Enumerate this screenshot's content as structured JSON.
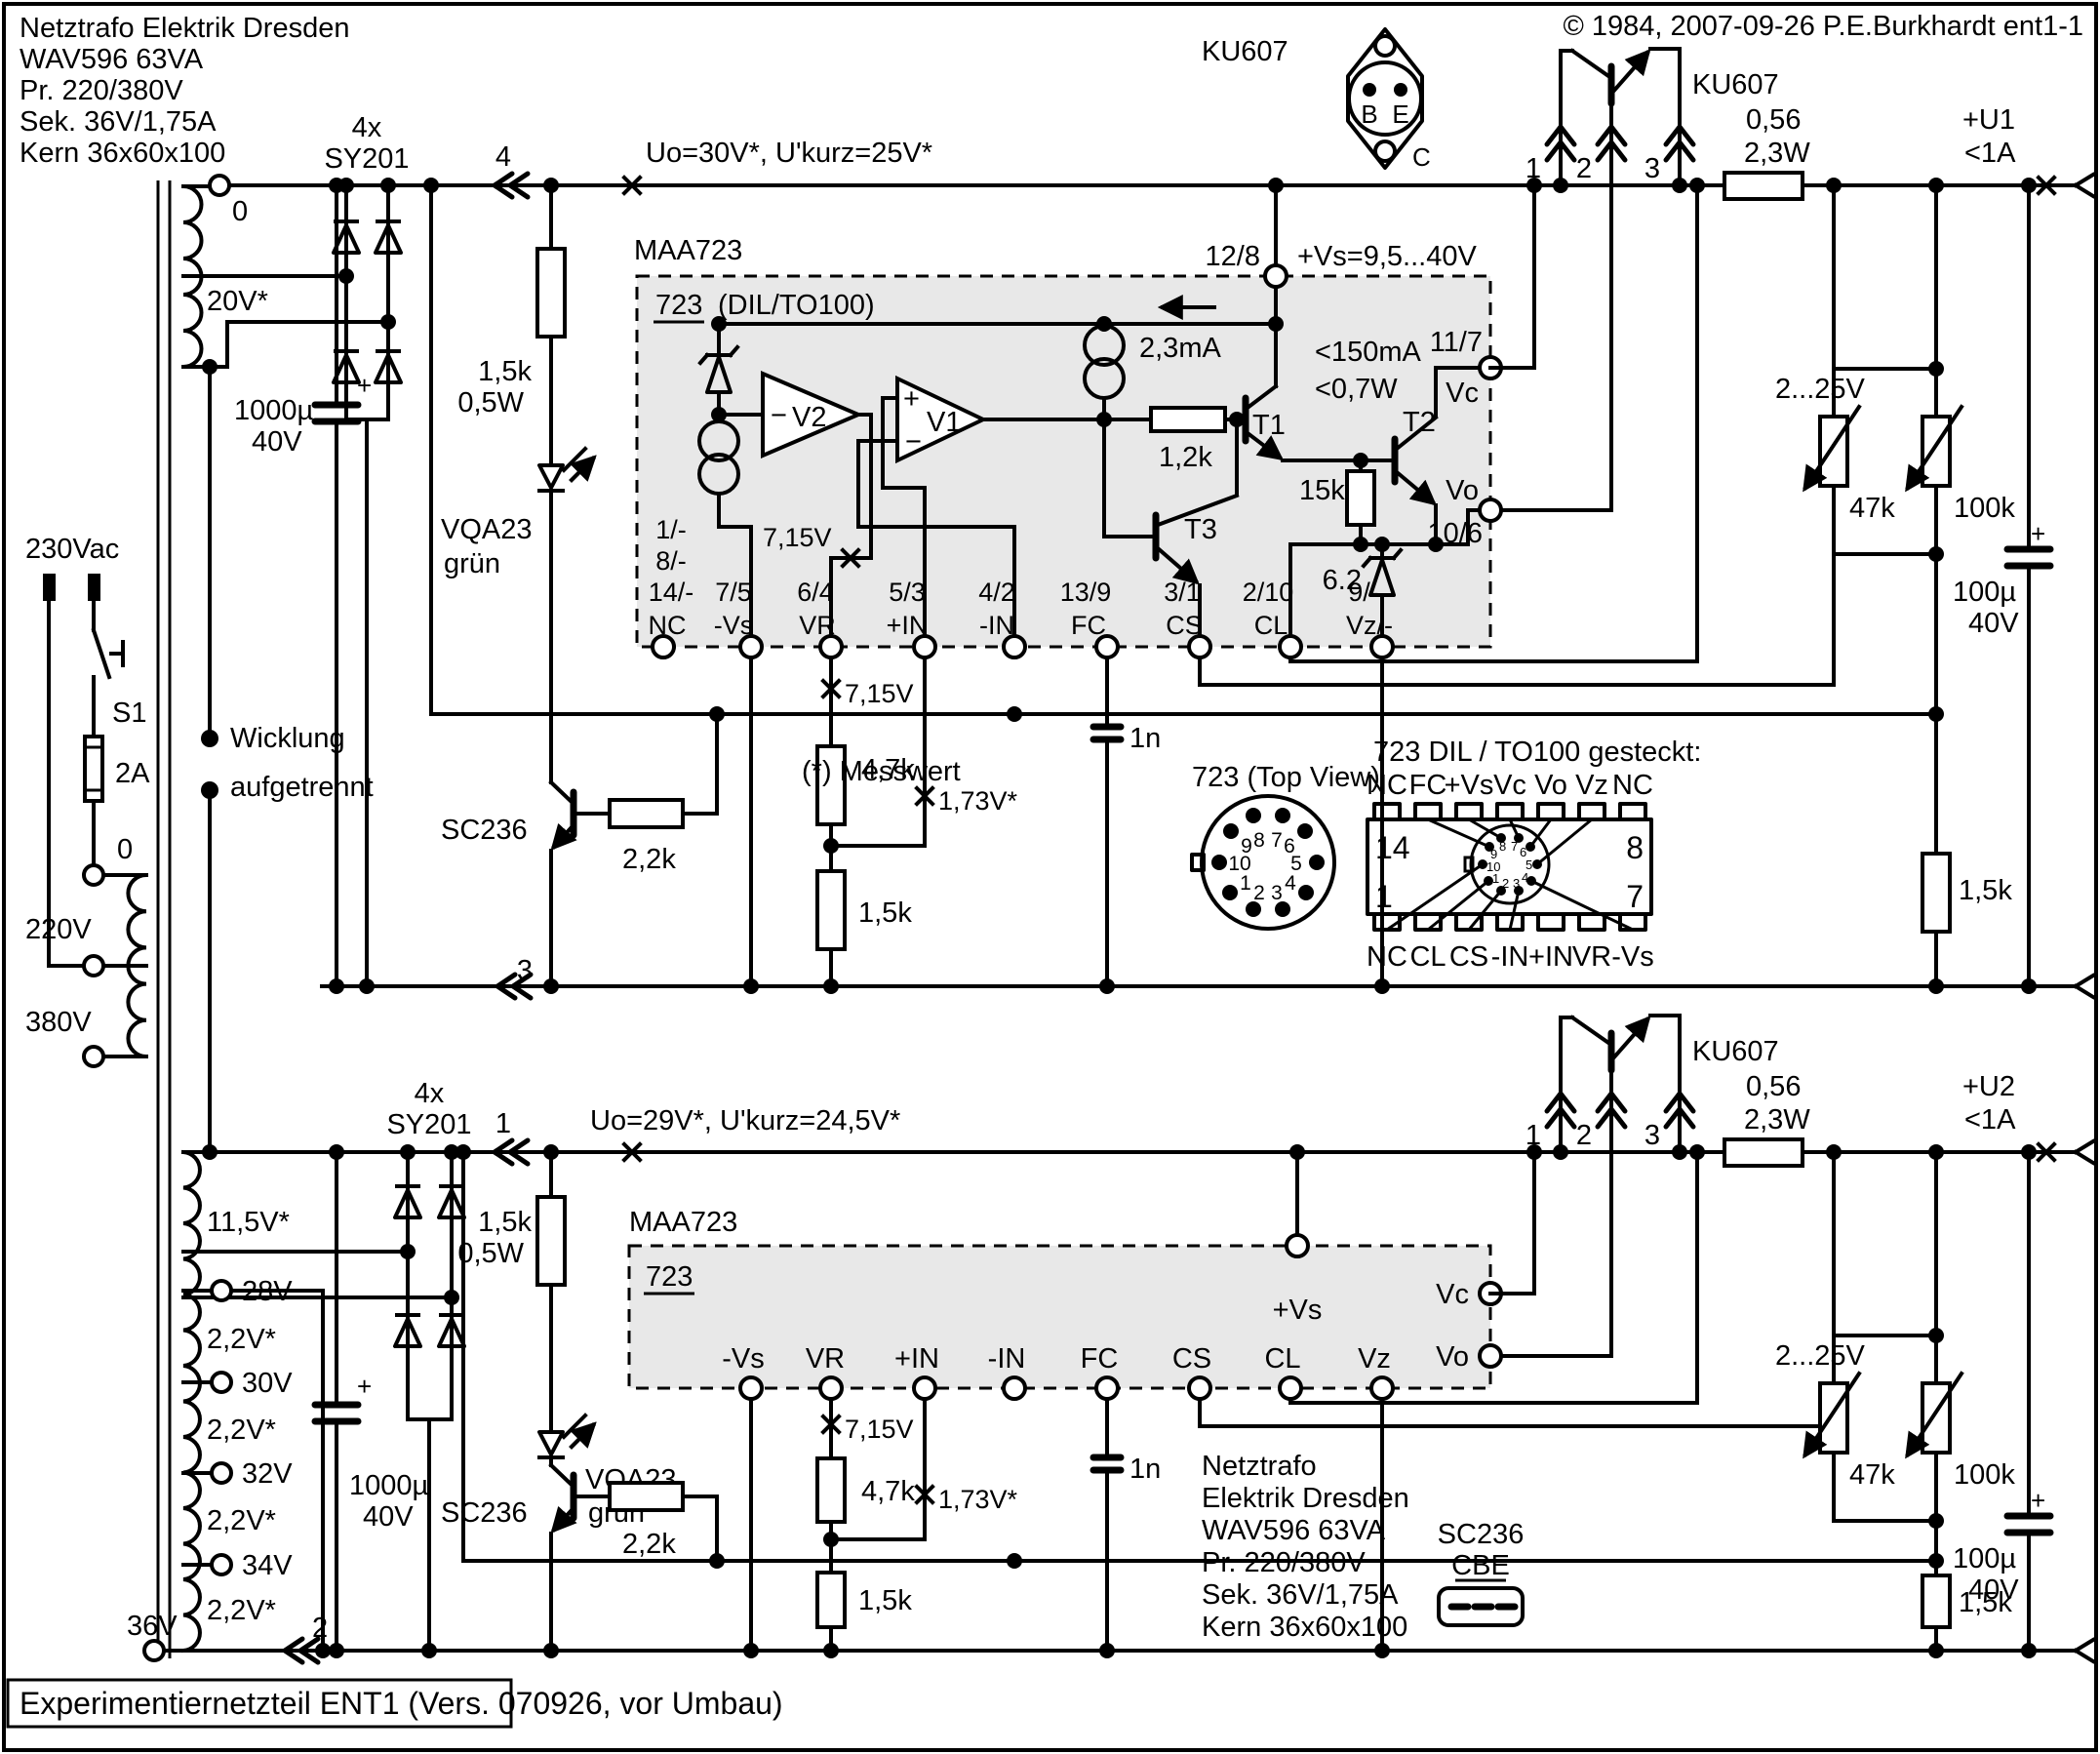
{
  "header": {
    "info": [
      "Netztrafo Elektrik Dresden",
      "WAV596 63VA",
      "Pr. 220/380V",
      "Sek. 36V/1,75A",
      "Kern 36x60x100"
    ],
    "copyright": "© 1984, 2007-09-26 P.E.Burkhardt ent1-1"
  },
  "footer": {
    "title": "Experimentiernetzteil ENT1 (Vers. 070926, vor Umbau)"
  },
  "note": {
    "messwert": "(*) Messwert"
  },
  "mains": {
    "label": "230Vac",
    "switch": "S1",
    "fuse": "2A",
    "taps": [
      "0",
      "220V",
      "380V"
    ],
    "note1": "Wicklung",
    "note2": "aufgetrennt"
  },
  "windings": {
    "w1": "20V*",
    "w1_top": "0",
    "w2": "11,5V*",
    "w2_taps": [
      "28V",
      "30V",
      "32V",
      "34V",
      "36V"
    ],
    "w2_steps": [
      "2,2V*",
      "2,2V*",
      "2,2V*",
      "2,2V*"
    ]
  },
  "s1": {
    "bridge_qty": "4x",
    "bridge_part": "SY201",
    "conn_pos": "4",
    "conn_neg": "3",
    "uo": "Uo=30V*, U'kurz=25V*",
    "r_led": "1,5k",
    "r_led_w": "0,5W",
    "cap": "1000µ",
    "cap_v": "40V",
    "led": "VQA23",
    "led_color": "grün",
    "tr": "SC236",
    "r_base": "2,2k",
    "r_div1": "4,7k",
    "r_div2": "1,5k",
    "m_ref": "7,15V",
    "m_in": "1,73V*",
    "cap_fc": "1n",
    "pass": "KU607",
    "p1": "1",
    "p2": "2",
    "p3": "3",
    "r_out": "0,56",
    "r_out_w": "2,3W",
    "out": "+U1",
    "out_i": "<1A",
    "adj_range": "2...25V",
    "pot1": "47k",
    "pot2": "100k",
    "cap_out": "100µ",
    "cap_out_v": "40V",
    "r_sense": "1,5k",
    "plus": "+"
  },
  "s2": {
    "bridge_qty": "4x",
    "bridge_part": "SY201",
    "conn_pos": "1",
    "conn_neg": "2",
    "uo": "Uo=29V*, U'kurz=24,5V*",
    "r_led": "1,5k",
    "r_led_w": "0,5W",
    "cap": "1000µ",
    "cap_v": "40V",
    "led": "VQA23",
    "led_color": "grün",
    "tr": "SC236",
    "r_base": "2,2k",
    "r_div1": "4,7k",
    "r_div2": "1,5k",
    "m_ref": "7,15V",
    "m_in": "1,73V*",
    "cap_fc": "1n",
    "pass": "KU607",
    "p1": "1",
    "p2": "2",
    "p3": "3",
    "r_out": "0,56",
    "r_out_w": "2,3W",
    "out": "+U2",
    "out_i": "<1A",
    "adj_range": "2...25V",
    "pot1": "47k",
    "pot2": "100k",
    "cap_out": "100µ",
    "cap_out_v": "40V",
    "r_sense": "1,5k",
    "plus": "+"
  },
  "ic1": {
    "name": "MAA723",
    "type": "723",
    "pkg": "(DIL/TO100)",
    "nc": [
      "1/-",
      "8/-",
      "14/-"
    ],
    "nc_name": "NC",
    "pins": [
      [
        "7/5",
        "-Vs"
      ],
      [
        "6/4",
        "VR"
      ],
      [
        "5/3",
        "+IN"
      ],
      [
        "4/2",
        "-IN"
      ],
      [
        "13/9",
        "FC"
      ],
      [
        "3/1",
        "CS"
      ],
      [
        "2/10",
        "CL"
      ],
      [
        "9/-",
        "Vz/-"
      ]
    ],
    "top_num": "12/8",
    "vs": "+Vs=9,5...40V",
    "ibias": "2,3mA",
    "imax": "<150mA",
    "pmax": "<0,7W",
    "vc_num": "11/7",
    "vc": "Vc",
    "vo_num": "10/6",
    "vo": "Vo",
    "v1": "V1",
    "v2": "V2",
    "t1": "T1",
    "t2": "T2",
    "t3": "T3",
    "r1": "1,2k",
    "r2": "15k",
    "dz": "6.2",
    "ref": "7,15V",
    "plus": "+",
    "minus": "−"
  },
  "ic2": {
    "name": "MAA723",
    "type": "723",
    "pins": [
      "-Vs",
      "VR",
      "+IN",
      "-IN",
      "FC",
      "CS",
      "CL",
      "Vz"
    ],
    "vs": "+Vs",
    "vc": "Vc",
    "vo": "Vo"
  },
  "to3": {
    "part": "KU607",
    "b": "B",
    "e": "E",
    "c": "C"
  },
  "topview": {
    "title": "723 (Top View)",
    "pins": [
      "1",
      "2",
      "3",
      "4",
      "5",
      "6",
      "7",
      "8",
      "9",
      "10"
    ]
  },
  "dil": {
    "title": "723 DIL / TO100 gesteckt:",
    "top": [
      "NC",
      "FC",
      "+Vs",
      "Vc",
      "Vo",
      "Vz",
      "NC"
    ],
    "bottom": [
      "NC",
      "CL",
      "CS",
      "-IN",
      "+IN",
      "VR",
      "-Vs"
    ],
    "c14": "14",
    "c8": "8",
    "c1": "1",
    "c7": "7",
    "pins": [
      "1",
      "2",
      "3",
      "4",
      "5",
      "6",
      "7",
      "8",
      "9",
      "10"
    ]
  },
  "pkg": {
    "part": "SC236",
    "pins": "CBE"
  },
  "info2": [
    "Netztrafo",
    "Elektrik Dresden",
    "WAV596 63VA",
    "Pr. 220/380V",
    "Sek. 36V/1,75A",
    "Kern 36x60x100"
  ]
}
